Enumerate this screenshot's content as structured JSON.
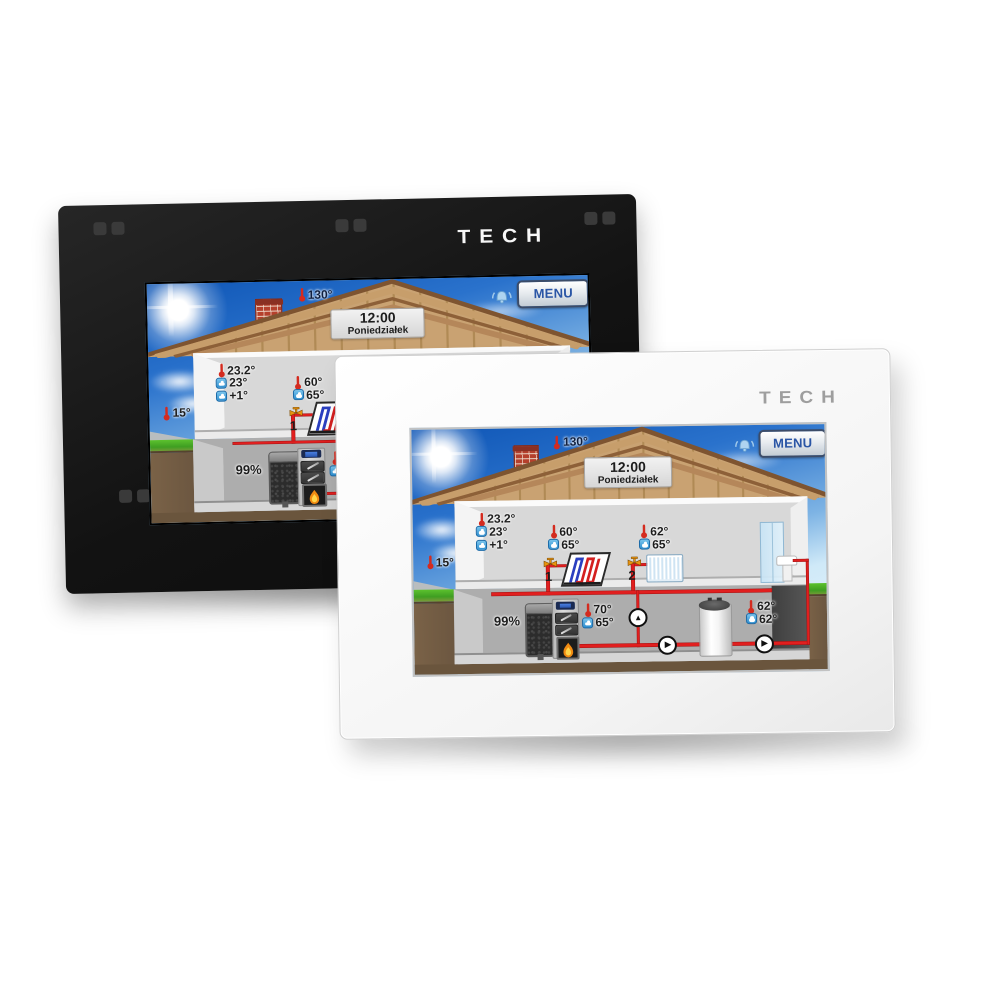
{
  "brand": {
    "logo_text": "TECH"
  },
  "devices": [
    {
      "name": "black wall controller",
      "body_color": "#161616"
    },
    {
      "name": "white wall controller",
      "body_color": "#ffffff"
    }
  ],
  "screen": {
    "header": {
      "menu_label": "MENU",
      "chimney_temp": "130°",
      "alarm_icon": "alarm-bell"
    },
    "clock": {
      "time": "12:00",
      "day": "Poniedziałek"
    },
    "weather": {
      "outdoor_temp": "15°"
    },
    "room": {
      "current_temp": "23.2°",
      "set_temp": "23°",
      "correction": "+1°"
    },
    "zones": [
      {
        "number": "1",
        "name": "floor-heating circuit",
        "temp": "60°",
        "set_temp": "65°"
      },
      {
        "number": "2",
        "name": "radiator circuit",
        "temp": "62°",
        "set_temp": "65°"
      }
    ],
    "boiler": {
      "fuel_level": "99%",
      "temp": "70°",
      "set_temp": "65°"
    },
    "dhw_tank": {
      "temp": "62°",
      "set_temp": "62°"
    }
  },
  "colors": {
    "pipe_red": "#e11f1f",
    "menu_text_blue": "#2a55a5",
    "sky_top": "#0f56b6",
    "sky_bottom": "#cfe9f8",
    "roof_tan": "#c9a272",
    "grass_green": "#3f9e22",
    "soil_brown": "#6b5640",
    "set_icon_blue": "#2e8fd0",
    "thermometer_red": "#d42b1f"
  }
}
